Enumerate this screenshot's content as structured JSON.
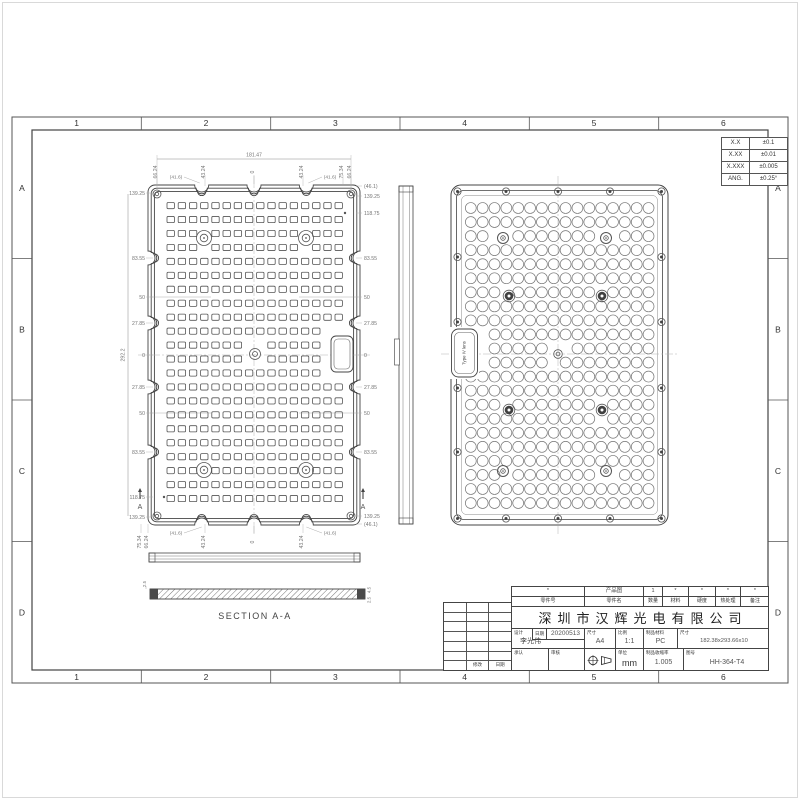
{
  "sheet": {
    "zone_columns": [
      "1",
      "2",
      "3",
      "4",
      "5",
      "6"
    ],
    "zone_rows": [
      "A",
      "B",
      "C",
      "D"
    ],
    "line_color": "#444444",
    "dim_color": "#767676"
  },
  "tolerance_table": {
    "rows": [
      [
        "X.X",
        "±0.1"
      ],
      [
        "X.XX",
        "±0.01"
      ],
      [
        "X.XXX",
        "±0.005"
      ],
      [
        "ANG.",
        "±0.25°"
      ]
    ]
  },
  "front_view": {
    "grid_cols": 16,
    "grid_rows": 22,
    "overall_width": "181.47",
    "overall_height": "292.2",
    "top_dims": [
      "66.24",
      "43.24",
      "0",
      "43.24",
      "75.34",
      "66.24"
    ],
    "bottom_dims": [
      "75.34",
      "66.24",
      "43.24",
      "0",
      "43.24"
    ],
    "left_dims": [
      "139.25",
      "83.55",
      "50",
      "27.85",
      "0",
      "27.85",
      "50",
      "83.55",
      "118.75",
      "139.25"
    ],
    "right_dims": [
      "(46.1)",
      "139.25",
      "118.75",
      "83.55",
      "50",
      "27.85",
      "0",
      "27.85",
      "50",
      "83.55",
      "139.25",
      "(46.1)"
    ],
    "fillet_label": "(41.6)",
    "section_arrow": "A"
  },
  "back_view": {
    "grid_cols": 16,
    "grid_rows": 22,
    "tab_label": "Type IV lens"
  },
  "section_view": {
    "title": "SECTION A-A",
    "left_dims": [
      "2.5"
    ],
    "right_dims": [
      "4.5",
      "2.5"
    ]
  },
  "title_block": {
    "header_values": [
      "*",
      "产品图",
      "1",
      "*",
      "*",
      "*",
      "*"
    ],
    "header_labels": [
      "零件号",
      "零件名",
      "数量",
      "材料",
      "硬度",
      "热处理",
      "备注"
    ],
    "company": "深圳市汉辉光电有限公司",
    "design_label": "设计",
    "designer": "李光伟",
    "date_label": "日期",
    "date": "20200513",
    "paper_label": "尺寸",
    "paper": "A4",
    "scale_label": "比例",
    "scale": "1:1",
    "material_label": "制品材料",
    "material": "PC",
    "size_label": "尺寸",
    "size": "182.38x293.66x10",
    "approve_label": "承认",
    "review_label": "审核",
    "unit_label": "单位",
    "unit": "mm",
    "shrinkage_label": "制品收缩率",
    "shrinkage": "1.005",
    "dwgno_label": "图号",
    "dwgno": "HH-364-T4",
    "revision_labels": [
      "",
      "修改",
      "日期"
    ]
  }
}
